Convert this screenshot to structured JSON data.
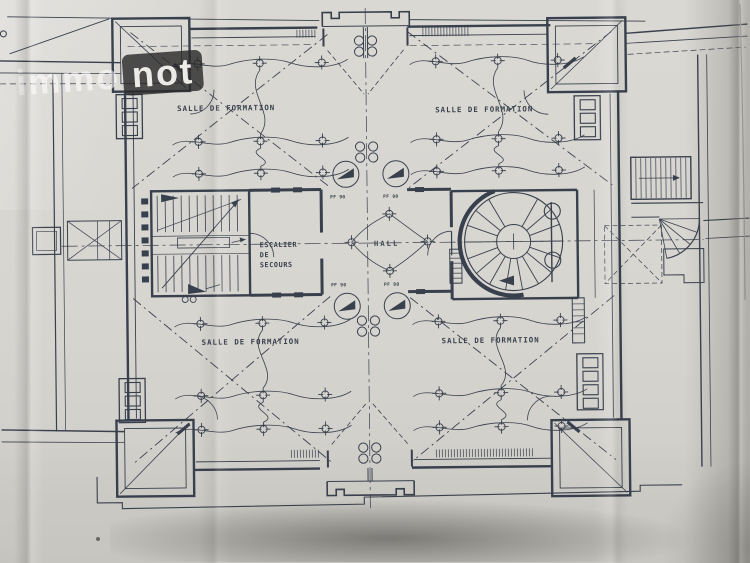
{
  "watermark": {
    "light": "immo",
    "dark": "not"
  },
  "plan": {
    "labels": {
      "salle_tl": "SALLE DE FORMATION",
      "salle_tr": "SALLE DE FORMATION",
      "salle_bl": "SALLE DE FORMATION",
      "salle_br": "SALLE DE FORMATION",
      "hall": "HALL",
      "escalier_1": "ESCALIER",
      "escalier_2": "DE",
      "escalier_3": "SECOURS",
      "door_tl": "PF 90",
      "door_tr": "PF 90",
      "door_bl": "PF 90",
      "door_br": "PF 90"
    }
  },
  "colors": {
    "ink": "#39404d",
    "paper": "#d8d6d1",
    "photo_bg": "#c6c4bf",
    "watermark_box": "#2b2b2b",
    "shadow": "#3e3c38"
  }
}
